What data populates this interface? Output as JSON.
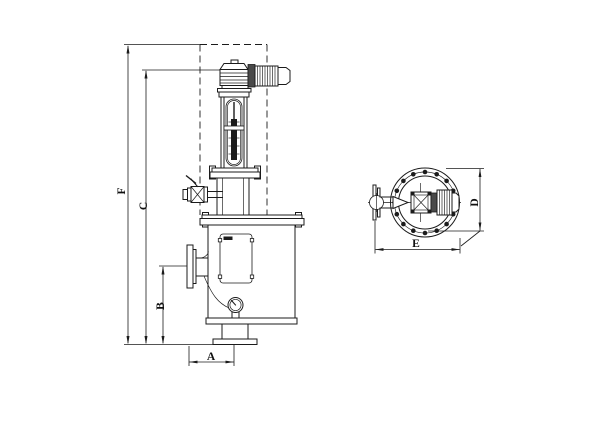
{
  "drawing": {
    "front_view": {
      "dimensions": {
        "overall_height_label": "F",
        "body_height_label": "C",
        "inlet_height_label": "B",
        "base_offset_label": "A"
      }
    },
    "top_view": {
      "dimensions": {
        "flange_diameter_label": "D",
        "overall_width_label": "E"
      }
    },
    "colors": {
      "line": "#1b1b1b",
      "background": "#ffffff"
    }
  }
}
